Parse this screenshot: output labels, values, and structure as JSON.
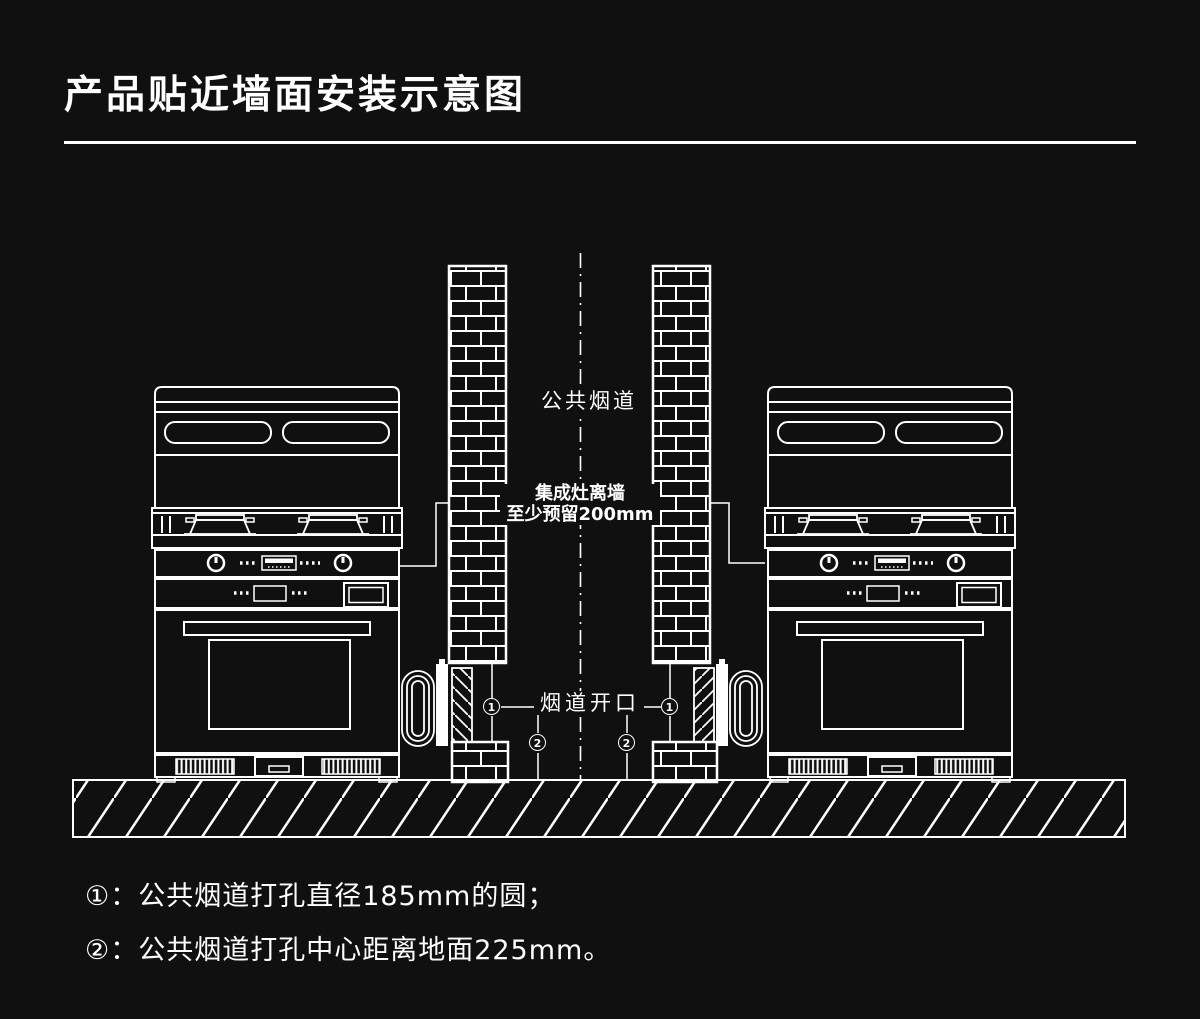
{
  "title": "产品贴近墙面安装示意图",
  "colors": {
    "background": "#101010",
    "line": "#ffffff",
    "text": "#ffffff"
  },
  "diagram": {
    "labels": {
      "flue": "公共烟道",
      "clearance_line1": "集成灶离墙",
      "clearance_line2": "至少预留200mm",
      "opening": "烟道开口",
      "marker1": "1",
      "marker2": "2"
    }
  },
  "notes": [
    "①：公共烟道打孔直径185mm的圆；",
    "②：公共烟道打孔中心距离地面225mm。"
  ]
}
